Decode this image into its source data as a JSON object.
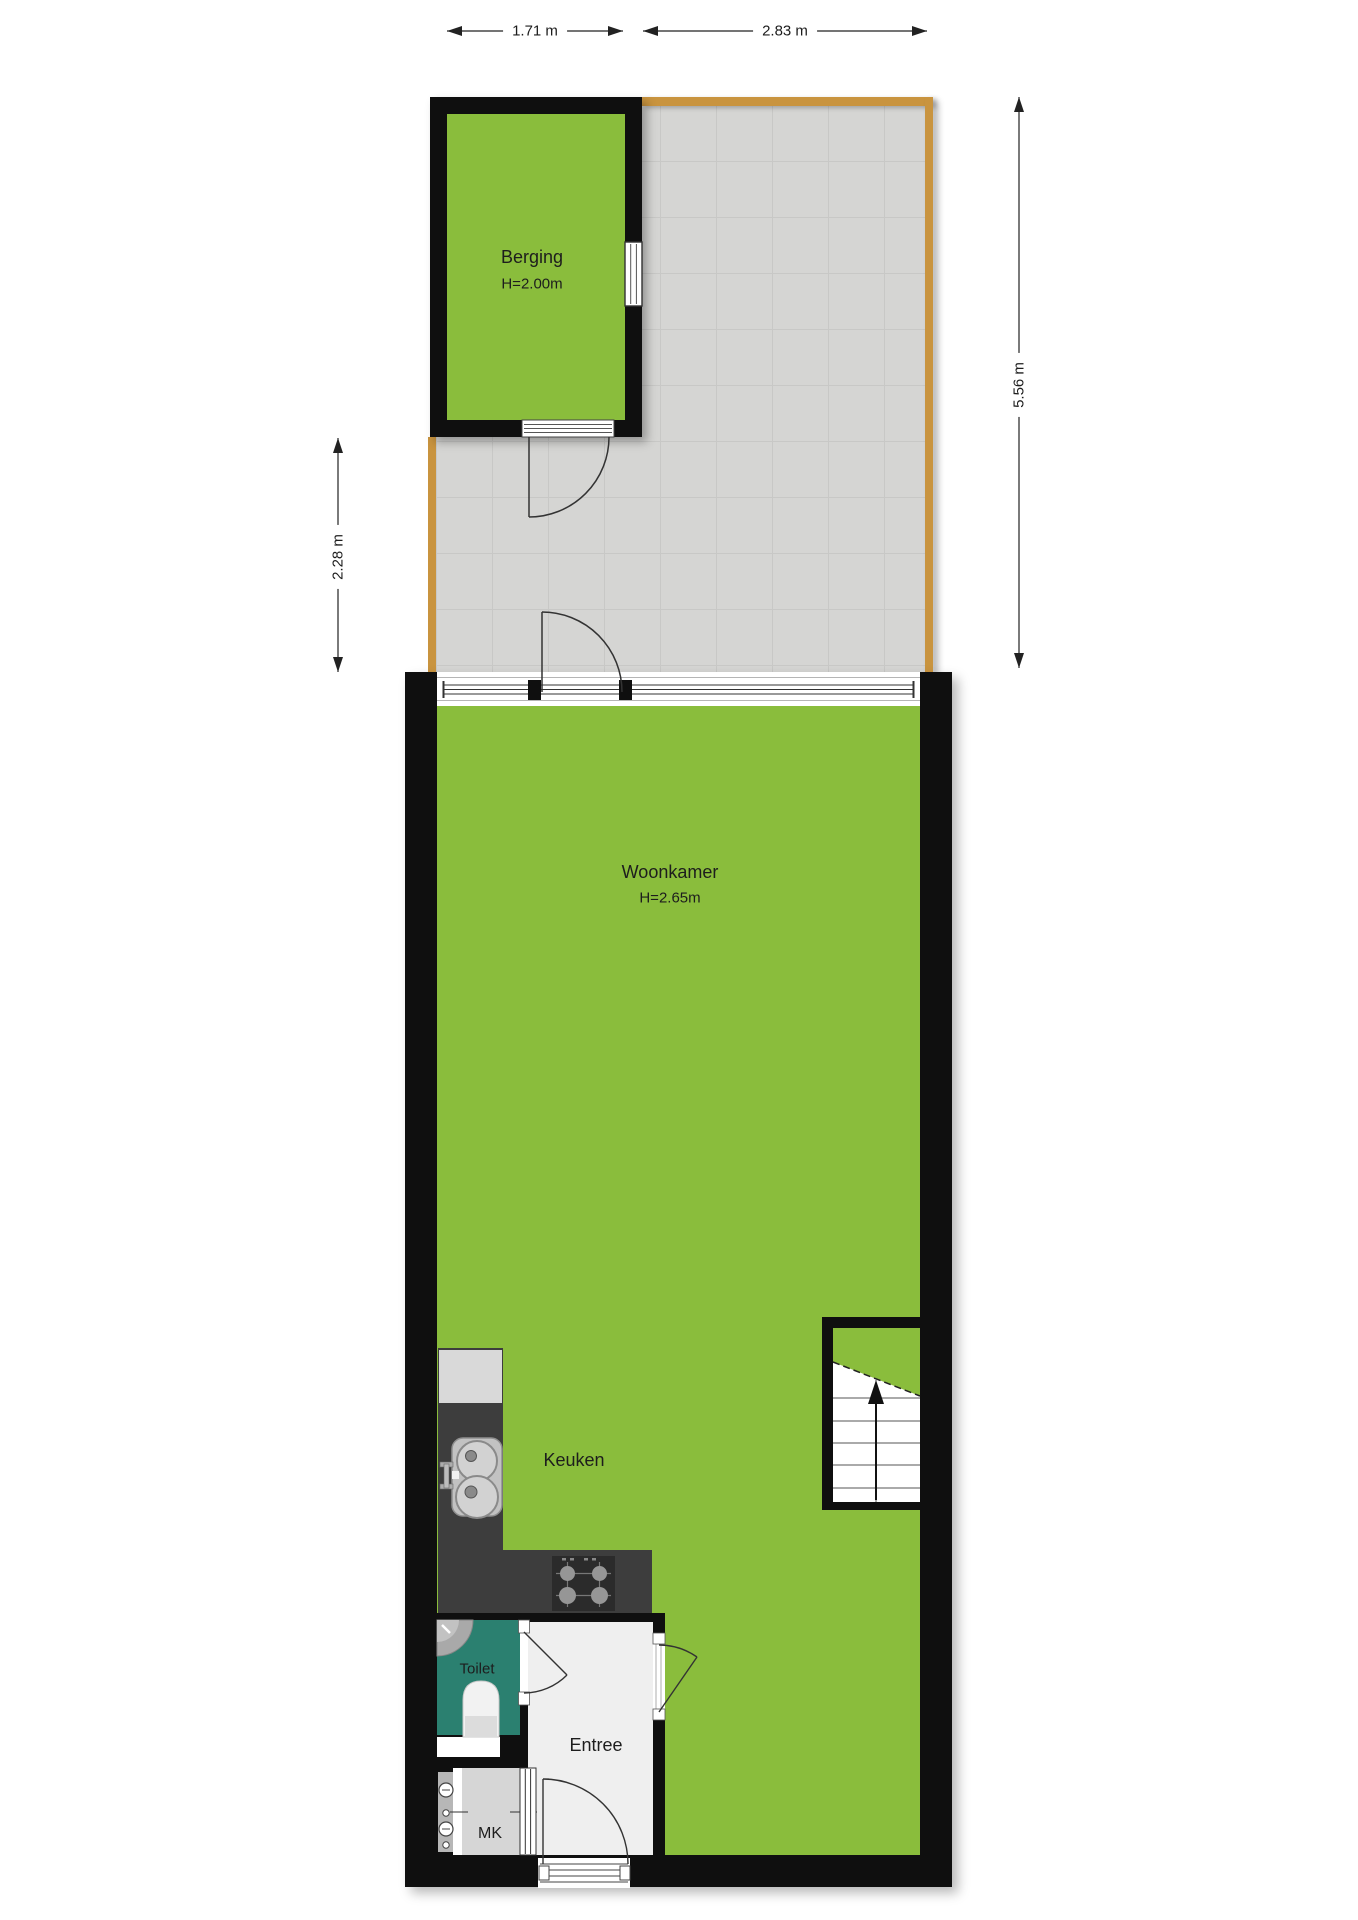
{
  "plan": {
    "type": "floorplan",
    "floor_description": "ground floor with storage shed and terrace"
  },
  "rooms": {
    "berging": {
      "label": "Berging",
      "ceiling": "H=2.00m"
    },
    "woonkamer": {
      "label": "Woonkamer",
      "ceiling": "H=2.65m"
    },
    "keuken": {
      "label": "Keuken"
    },
    "toilet": {
      "label": "Toilet"
    },
    "entree": {
      "label": "Entree"
    },
    "mk": {
      "label": "MK"
    }
  },
  "dimensions": {
    "top_left": "1.71 m",
    "top_right": "2.83 m",
    "right": "5.56 m",
    "left": "2.28 m"
  },
  "colors": {
    "room_green": "#8abd3c",
    "wall_black": "#0f0f0f",
    "terrace_gray": "#d5d5d3",
    "terrace_grid": "#c8c8c6",
    "wood_trim": "#c9943f",
    "counter_dark": "#3d3d3d",
    "hob_dark": "#2b2b2b",
    "toilet_teal": "#2b8070",
    "entree_floor": "#efefef",
    "mk_floor": "#d6d6d6",
    "fixture_gray": "#c6c6c6",
    "line_color": "#1d1d1d"
  }
}
